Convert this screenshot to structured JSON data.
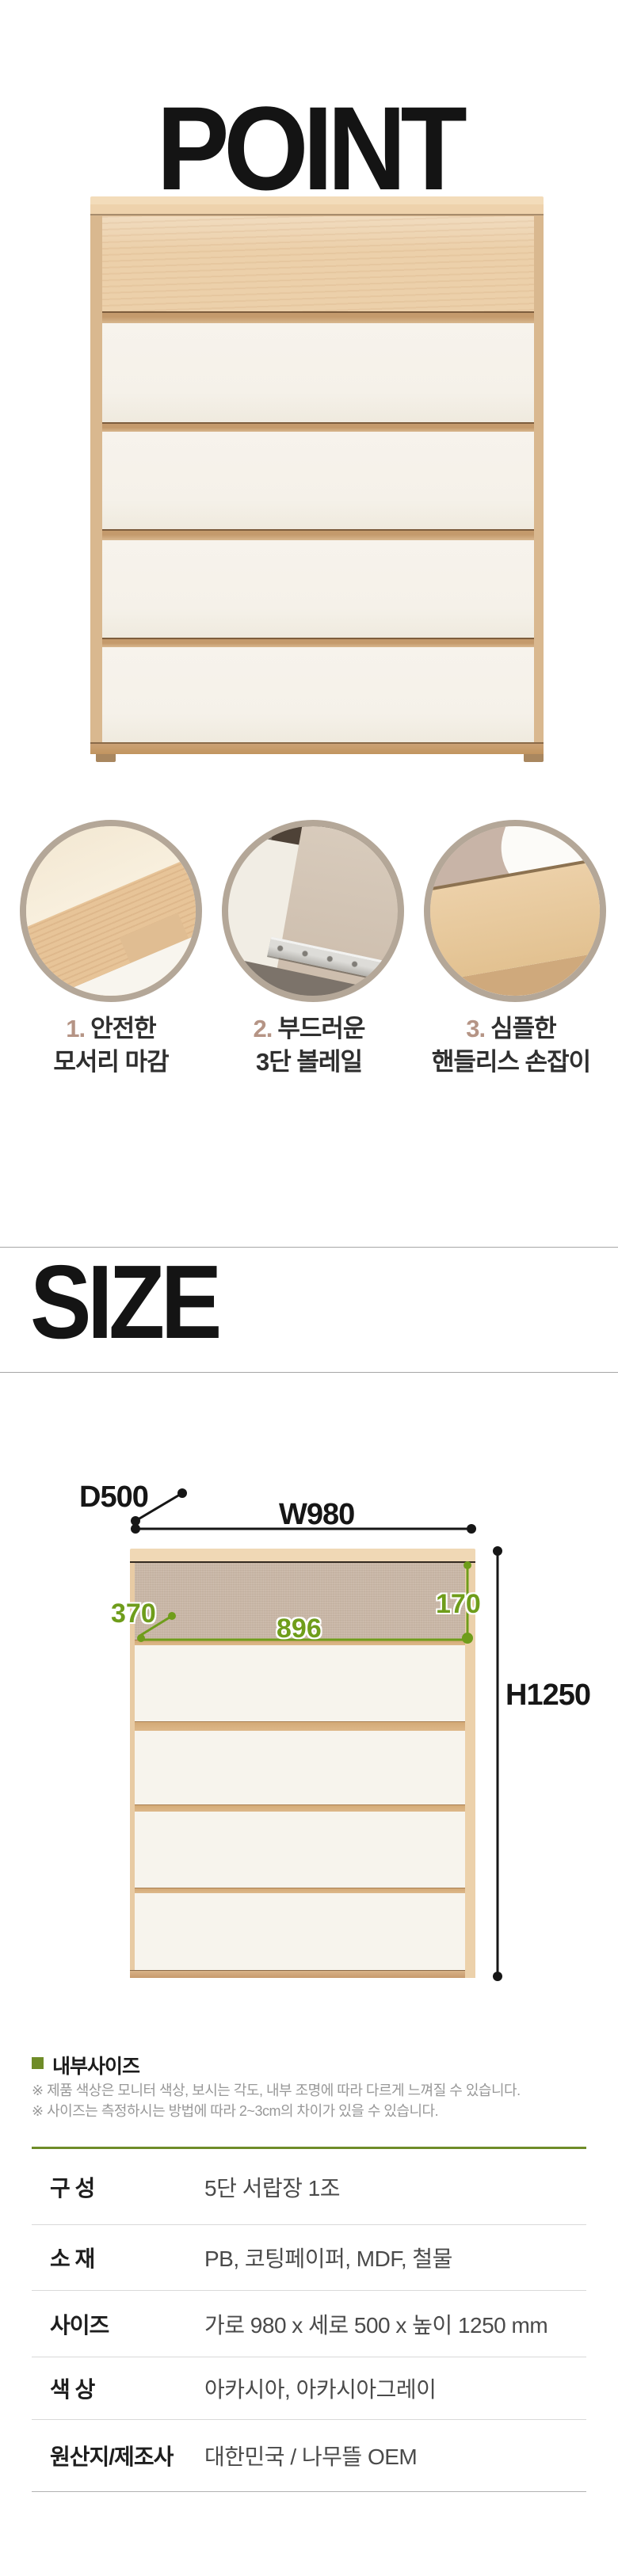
{
  "point_section": {
    "heading": "POINT",
    "features": [
      {
        "number": "1.",
        "line1": "안전한",
        "line2": "모서리 마감"
      },
      {
        "number": "2.",
        "line1": "부드러운",
        "line2": "3단 볼레일"
      },
      {
        "number": "3.",
        "line1": "심플한",
        "line2": "핸들리스 손잡이"
      }
    ]
  },
  "size_section": {
    "heading": "SIZE",
    "dimensions": {
      "depth": "D500",
      "width": "W980",
      "height": "H1250",
      "inner_left": "370",
      "inner_width": "896",
      "inner_height": "170"
    },
    "legend_label": "내부사이즈",
    "notes": [
      "※ 제품 색상은 모니터 색상, 보시는 각도, 내부 조명에 따라 다르게 느껴질 수 있습니다.",
      "※ 사이즈는 측정하시는 방법에 따라 2~3cm의 차이가 있을 수 있습니다."
    ]
  },
  "spec_table": {
    "rows": [
      {
        "label": "구 성",
        "value": "5단 서랍장 1조"
      },
      {
        "label": "소 재",
        "value": "PB, 코팅페이퍼, MDF, 철물"
      },
      {
        "label": "사이즈",
        "value": "가로 980 x 세로 500 x 높이 1250 mm"
      },
      {
        "label": "색 상",
        "value": "아카시아, 아카시아그레이"
      },
      {
        "label": "원산지/제조사",
        "value": "대한민국 / 나무뜰 OEM"
      }
    ]
  },
  "colors": {
    "measure_green": "#6f9d1b",
    "olive_accent": "#6f8c28",
    "feature_number_tan": "#b59485",
    "wood": "#ecd0aa",
    "drawer_white": "#f6f2ea"
  }
}
